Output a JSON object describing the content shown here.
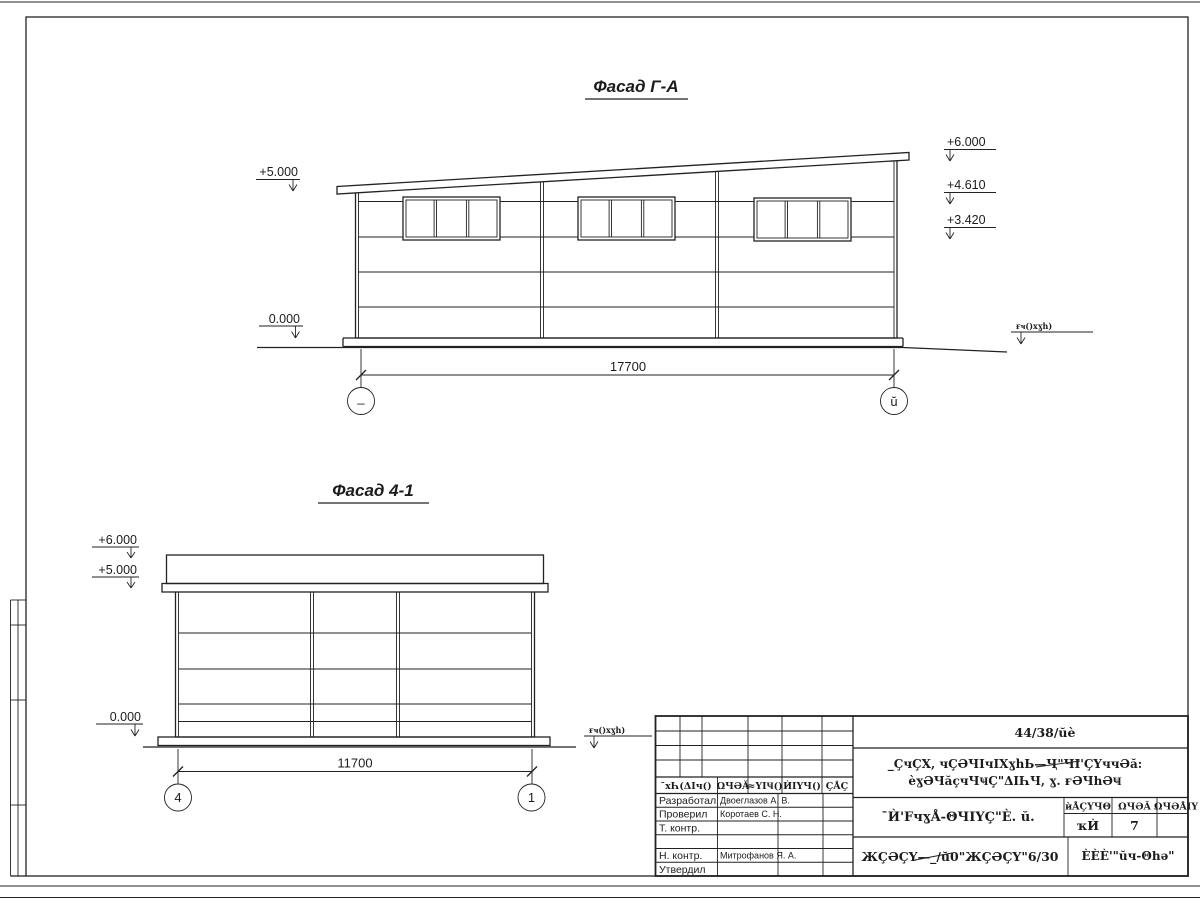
{
  "drawing": {
    "facade_ga": {
      "title": "Фасад Г-А",
      "elev_plus5": "+5.000",
      "elev_0": "0.000",
      "elev_plus6": "+6.000",
      "elev_plus4610": "+4.610",
      "elev_plus3420": "+3.420",
      "ground_label": "ғҹ()xɣһ)",
      "dim": "17700",
      "axis_left": "_",
      "axis_right": "ŭ"
    },
    "facade_41": {
      "title": "Фасад 4-1",
      "elev_plus6": "+6.000",
      "elev_plus5": "+5.000",
      "elev_0": "0.000",
      "ground_label": "ғҹ()xɣһ)",
      "dim": "11700",
      "axis_left": "4",
      "axis_right": "1"
    }
  },
  "titleblock": {
    "doc_number": "44/38/ŭè",
    "project_line1": "_ÇчÇХ, чÇӘЧIчIХɣhЬ—Ҷ\"ЧI'ÇҮччӘă:",
    "project_line2": "èɣӘЧăçчЧҸÇ\"ΔIҺЧ, ɣ. ғӘЧһӘҸ",
    "rev_headers": [
      "¯хҺ(ΔIч()",
      "ΩЧӘĂ",
      "≈ҮIҸ()",
      "ЍIҮЧ()",
      "ÇÅÇ"
    ],
    "roles": [
      {
        "label": "Разработал",
        "name": "Двоеглазов А. В."
      },
      {
        "label": "Проверил",
        "name": "Коротаев С. Н."
      },
      {
        "label": "Т. контр.",
        "name": ""
      },
      {
        "label": "",
        "name": ""
      },
      {
        "label": "Н. контр.",
        "name": "Митрофанов Я. А."
      },
      {
        "label": "Утвердил",
        "name": ""
      }
    ],
    "sheet_title": "¯Ѝ'FчɣÅ-ΘЧIҮÇ\"È. ŭ.",
    "mini_headers": [
      "ѝÅÇҮЧΘ",
      "ΩЧӘĂ",
      "ΩЧӘÅIҮ"
    ],
    "mini_values": [
      "ҡЍ",
      "7",
      ""
    ],
    "doc_code": "ЖÇӘÇҮ—_/ŭ0\"ЖÇӘÇҮ\"6/30",
    "company": "ÈÈÈ'\"ŭч-Θһә\""
  }
}
